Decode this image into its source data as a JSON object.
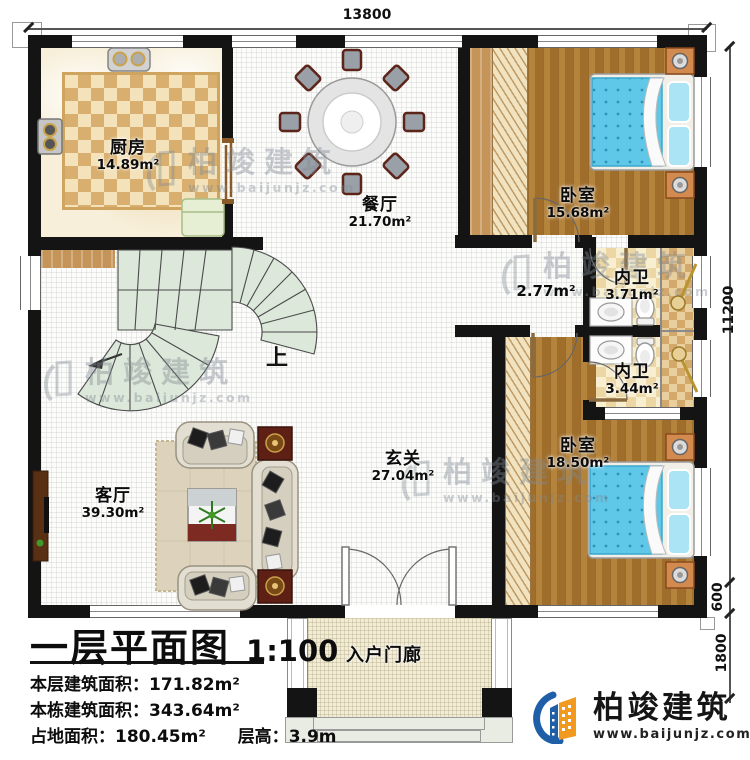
{
  "dimensions": {
    "top_width": "13800",
    "right_main": "11200",
    "right_lower": "600",
    "right_porch": "1800"
  },
  "rooms": {
    "kitchen": {
      "name": "厨房",
      "area": "14.89m²"
    },
    "dining": {
      "name": "餐厅",
      "area": "21.70m²"
    },
    "bedroom_top": {
      "name": "卧室",
      "area": "15.68m²"
    },
    "bath_top": {
      "name": "内卫",
      "area": "3.71m²"
    },
    "bath_bottom": {
      "name": "内卫",
      "area": "3.44m²"
    },
    "bedroom_bottom": {
      "name": "卧室",
      "area": "18.50m²"
    },
    "hallway": {
      "area": "2.77m²"
    },
    "foyer": {
      "name": "玄关",
      "area": "27.04m²"
    },
    "living": {
      "name": "客厅",
      "area": "39.30m²"
    },
    "porch": {
      "name": "入户门廊"
    }
  },
  "stairs": {
    "direction_label": "上"
  },
  "title_block": {
    "title": "一层平面图",
    "scale": "1:100",
    "floor_area_label": "本层建筑面积：",
    "floor_area_value": "171.82m²",
    "building_area_label": "本栋建筑面积：",
    "building_area_value": "343.64m²",
    "footprint_label": "占地面积：",
    "footprint_value": "180.45m²",
    "height_label": "层高：",
    "height_value": "3.9m"
  },
  "brand": {
    "name": "柏竣建筑",
    "website": "www.baijunjz.com"
  },
  "watermark": {
    "name": "柏竣建筑",
    "website": "www.baijunjz.com"
  },
  "colors": {
    "wall": "#141414",
    "wood_floor": "#a87730",
    "bed_blue": "#5fc8e8",
    "stair_green": "#dce8da",
    "checker_tan": "#d8af6e",
    "logo_blue": "#1f5fa8",
    "logo_orange": "#f29a1f"
  }
}
